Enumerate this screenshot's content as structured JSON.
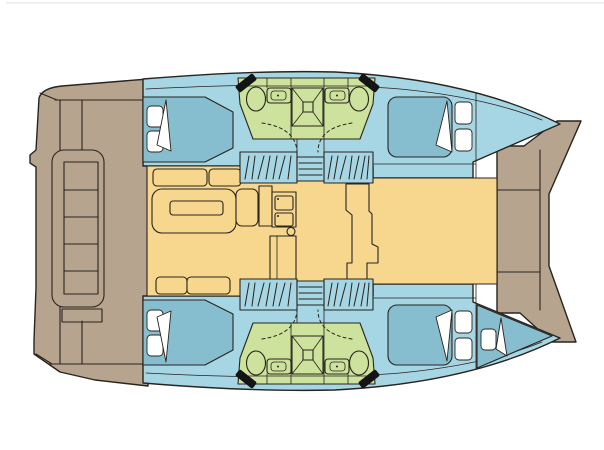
{
  "diagram": {
    "title": "Catamaran interior floor plan — top-down view",
    "type": "boat-floor-plan"
  },
  "colors": {
    "background": "#ffffff",
    "top_border": "#ebebeb",
    "outline": "#28241e",
    "deck": "#b7a48e",
    "hull": "#a6d5e4",
    "salon": "#f7d78e",
    "wet_area": "#cde29c",
    "berth": "#86becf",
    "linen": "#ffffff",
    "toilet_seat": "#141414"
  },
  "regions": {
    "aft_deck": "aft cockpit deck with bench and transom steps",
    "foredeck": "foredeck between bows",
    "salon": "salon with dinette, galley and nav console",
    "port_hull": "port hull (top)",
    "starboard_hull": "starboard hull (bottom)",
    "port_aft_cabin": "port aft double cabin",
    "port_forward_cabin": "port forward double cabin",
    "starboard_aft_cabin": "starboard aft double cabin",
    "starboard_forward_cabin": "starboard forward double cabin",
    "forepeak_berth": "starboard forepeak single berth",
    "port_wet_room": "port heads: 2 toilets, 2 basins, central shower",
    "starboard_wet_room": "starboard heads: 2 toilets, 2 basins, central shower",
    "companionways": "hatched companionway steps from salon into each hull"
  },
  "inventory": {
    "double_berths": 4,
    "single_berths": 1,
    "toilets": 4,
    "basins": 4,
    "showers": 2,
    "companionway_steps": 4,
    "pillows": 9
  }
}
